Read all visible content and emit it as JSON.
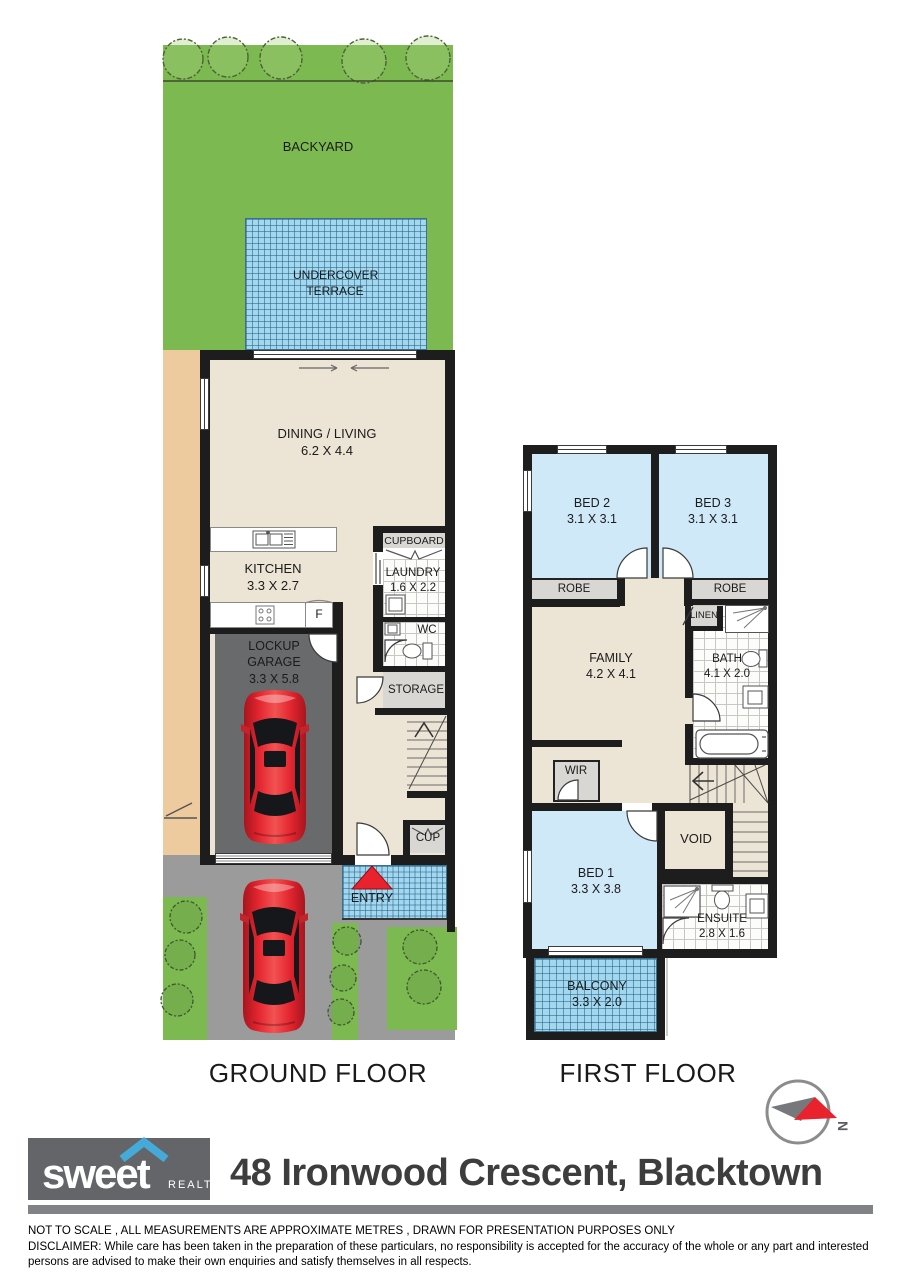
{
  "colors": {
    "wall": "#1d1d1d",
    "green": "#7cb950",
    "tan": "#eecb9e",
    "cream": "#ece4d4",
    "bed_blue": "#cfe9f8",
    "tile_blue": "#a3d7ee",
    "room_grey": "#d8d7d3",
    "garage_grey": "#696a6c",
    "drive_grey": "#9b9b9b",
    "red": "#e8232d",
    "brand_grey": "#636569",
    "brand_blue": "#45aad9",
    "bar_grey": "#808285",
    "text_dark": "#1b1b1b"
  },
  "ground": {
    "title": "GROUND FLOOR",
    "rooms": {
      "backyard": {
        "name": "BACKYARD"
      },
      "terrace": {
        "name": "UNDERCOVER TERRACE"
      },
      "dining": {
        "name": "DINING / LIVING",
        "dims": "6.2 X 4.4"
      },
      "kitchen": {
        "name": "KITCHEN",
        "dims": "3.3 X 2.7"
      },
      "fridge": {
        "label": "F"
      },
      "cupboard": {
        "name": "CUPBOARD"
      },
      "laundry": {
        "name": "LAUNDRY",
        "dims": "1.6 X 2.2"
      },
      "wc": {
        "name": "WC"
      },
      "garage": {
        "name": "LOCKUP GARAGE",
        "dims": "3.3 X 5.8"
      },
      "storage": {
        "name": "STORAGE"
      },
      "cup": {
        "name": "CUP"
      },
      "entry": {
        "name": "ENTRY"
      }
    }
  },
  "first": {
    "title": "FIRST FLOOR",
    "rooms": {
      "bed2": {
        "name": "BED 2",
        "dims": "3.1 X 3.1"
      },
      "bed3": {
        "name": "BED 3",
        "dims": "3.1 X 3.1"
      },
      "robe_left": {
        "name": "ROBE"
      },
      "robe_right": {
        "name": "ROBE"
      },
      "family": {
        "name": "FAMILY",
        "dims": "4.2 X 4.1"
      },
      "linen": {
        "name": "LINEN"
      },
      "bath": {
        "name": "BATH",
        "dims": "4.1 X 2.0"
      },
      "wir": {
        "name": "WIR"
      },
      "bed1": {
        "name": "BED 1",
        "dims": "3.3 X 3.8"
      },
      "void": {
        "name": "VOID"
      },
      "ensuite": {
        "name": "ENSUITE",
        "dims": "2.8 X 1.6"
      },
      "balcony": {
        "name": "BALCONY",
        "dims": "3.3 X 2.0"
      }
    }
  },
  "compass": {
    "north": "N"
  },
  "footer": {
    "brand": "sweet",
    "brand_sub": "REALTY",
    "address": "48 Ironwood Crescent, Blacktown",
    "note": "NOT TO SCALE , ALL MEASUREMENTS ARE APPROXIMATE METRES , DRAWN FOR PRESENTATION PURPOSES ONLY",
    "disclaimer": "DISCLAIMER:  While care has been taken in the preparation of these particulars, no responsibility is accepted for the accuracy of the whole or any part and interested persons are advised to make their own enquiries and satisfy  themselves in all respects."
  }
}
